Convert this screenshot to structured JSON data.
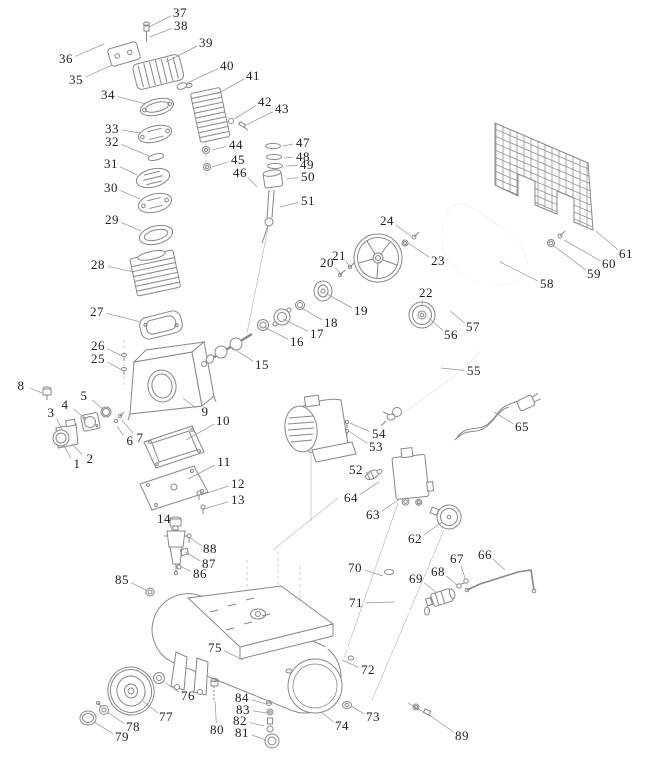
{
  "diagram": {
    "kind": "exploded-parts-diagram",
    "subject": "air compressor pump, motor, belt drive, tank and wheel assembly",
    "background_color": "#ffffff",
    "part_line_color": "#878787",
    "leader_line_color": "#9a9a9a",
    "label_color": "#1e1e1e",
    "label_count": 89,
    "labels": [
      {
        "n": "1",
        "x": 77,
        "y": 464,
        "tx": 64,
        "ty": 446
      },
      {
        "n": "2",
        "x": 90,
        "y": 459,
        "tx": 72,
        "ty": 444
      },
      {
        "n": "3",
        "x": 51,
        "y": 413,
        "tx": 62,
        "ty": 429
      },
      {
        "n": "4",
        "x": 65,
        "y": 405,
        "tx": 86,
        "ty": 419
      },
      {
        "n": "5",
        "x": 84,
        "y": 396,
        "tx": 104,
        "ty": 410
      },
      {
        "n": "6",
        "x": 130,
        "y": 441,
        "tx": 117,
        "ty": 426
      },
      {
        "n": "7",
        "x": 140,
        "y": 438,
        "tx": 122,
        "ty": 420
      },
      {
        "n": "8",
        "x": 21,
        "y": 386,
        "tx": 42,
        "ty": 393
      },
      {
        "n": "9",
        "x": 205,
        "y": 412,
        "tx": 183,
        "ty": 398
      },
      {
        "n": "10",
        "x": 223,
        "y": 421,
        "tx": 186,
        "ty": 440
      },
      {
        "n": "11",
        "x": 224,
        "y": 462,
        "tx": 188,
        "ty": 479
      },
      {
        "n": "12",
        "x": 238,
        "y": 484,
        "tx": 201,
        "ty": 495
      },
      {
        "n": "13",
        "x": 238,
        "y": 500,
        "tx": 204,
        "ty": 509
      },
      {
        "n": "14",
        "x": 164,
        "y": 519,
        "tx": 172,
        "ty": 530
      },
      {
        "n": "15",
        "x": 262,
        "y": 365,
        "tx": 231,
        "ty": 347
      },
      {
        "n": "16",
        "x": 297,
        "y": 342,
        "tx": 264,
        "ty": 327
      },
      {
        "n": "17",
        "x": 317,
        "y": 334,
        "tx": 283,
        "ty": 319
      },
      {
        "n": "18",
        "x": 331,
        "y": 323,
        "tx": 300,
        "ty": 307
      },
      {
        "n": "19",
        "x": 361,
        "y": 311,
        "tx": 327,
        "ty": 294
      },
      {
        "n": "20",
        "x": 327,
        "y": 263,
        "tx": 340,
        "ty": 273
      },
      {
        "n": "21",
        "x": 339,
        "y": 256,
        "tx": 350,
        "ty": 267
      },
      {
        "n": "22",
        "x": 426,
        "y": 293,
        "tx": 422,
        "ty": 305
      },
      {
        "n": "23",
        "x": 438,
        "y": 261,
        "tx": 408,
        "ty": 243
      },
      {
        "n": "24",
        "x": 387,
        "y": 221,
        "tx": 411,
        "ty": 236
      },
      {
        "n": "25",
        "x": 98,
        "y": 359,
        "tx": 122,
        "ty": 370
      },
      {
        "n": "26",
        "x": 98,
        "y": 346,
        "tx": 122,
        "ty": 356
      },
      {
        "n": "27",
        "x": 97,
        "y": 312,
        "tx": 141,
        "ty": 322
      },
      {
        "n": "28",
        "x": 98,
        "y": 265,
        "tx": 134,
        "ty": 272
      },
      {
        "n": "29",
        "x": 112,
        "y": 220,
        "tx": 141,
        "ty": 231
      },
      {
        "n": "30",
        "x": 111,
        "y": 188,
        "tx": 140,
        "ty": 199
      },
      {
        "n": "31",
        "x": 111,
        "y": 164,
        "tx": 137,
        "ty": 175
      },
      {
        "n": "32",
        "x": 112,
        "y": 142,
        "tx": 149,
        "ty": 156
      },
      {
        "n": "33",
        "x": 112,
        "y": 129,
        "tx": 140,
        "ty": 133
      },
      {
        "n": "34",
        "x": 108,
        "y": 95,
        "tx": 146,
        "ty": 104
      },
      {
        "n": "35",
        "x": 76,
        "y": 80,
        "tx": 112,
        "ty": 65
      },
      {
        "n": "36",
        "x": 66,
        "y": 59,
        "tx": 104,
        "ty": 44
      },
      {
        "n": "37",
        "x": 180,
        "y": 13,
        "tx": 149,
        "ty": 27
      },
      {
        "n": "38",
        "x": 181,
        "y": 26,
        "tx": 150,
        "ty": 37
      },
      {
        "n": "39",
        "x": 206,
        "y": 43,
        "tx": 166,
        "ty": 62
      },
      {
        "n": "40",
        "x": 227,
        "y": 66,
        "tx": 187,
        "ty": 83
      },
      {
        "n": "41",
        "x": 253,
        "y": 76,
        "tx": 217,
        "ty": 94
      },
      {
        "n": "42",
        "x": 265,
        "y": 102,
        "tx": 234,
        "ty": 119
      },
      {
        "n": "43",
        "x": 282,
        "y": 109,
        "tx": 244,
        "ty": 126
      },
      {
        "n": "44",
        "x": 236,
        "y": 145,
        "tx": 212,
        "ty": 150
      },
      {
        "n": "45",
        "x": 238,
        "y": 160,
        "tx": 212,
        "ty": 167
      },
      {
        "n": "46",
        "x": 240,
        "y": 173,
        "tx": 257,
        "ty": 187
      },
      {
        "n": "47",
        "x": 303,
        "y": 143,
        "tx": 283,
        "ty": 146
      },
      {
        "n": "48",
        "x": 303,
        "y": 157,
        "tx": 284,
        "ty": 158
      },
      {
        "n": "49",
        "x": 307,
        "y": 165,
        "tx": 286,
        "ty": 166
      },
      {
        "n": "50",
        "x": 308,
        "y": 177,
        "tx": 287,
        "ty": 179
      },
      {
        "n": "51",
        "x": 308,
        "y": 201,
        "tx": 280,
        "ty": 207
      },
      {
        "n": "52",
        "x": 356,
        "y": 470,
        "tx": 370,
        "ty": 474
      },
      {
        "n": "53",
        "x": 376,
        "y": 447,
        "tx": 349,
        "ty": 431
      },
      {
        "n": "54",
        "x": 379,
        "y": 434,
        "tx": 350,
        "ty": 423
      },
      {
        "n": "55",
        "x": 474,
        "y": 371,
        "tx": 441,
        "ty": 368
      },
      {
        "n": "56",
        "x": 451,
        "y": 335,
        "tx": 429,
        "ty": 318
      },
      {
        "n": "57",
        "x": 473,
        "y": 327,
        "tx": 450,
        "ty": 311
      },
      {
        "n": "58",
        "x": 547,
        "y": 284,
        "tx": 500,
        "ty": 262
      },
      {
        "n": "59",
        "x": 594,
        "y": 274,
        "tx": 554,
        "ty": 246
      },
      {
        "n": "60",
        "x": 609,
        "y": 264,
        "tx": 564,
        "ty": 240
      },
      {
        "n": "61",
        "x": 626,
        "y": 254,
        "tx": 596,
        "ty": 231
      },
      {
        "n": "62",
        "x": 415,
        "y": 539,
        "tx": 442,
        "ty": 522
      },
      {
        "n": "63",
        "x": 373,
        "y": 515,
        "tx": 401,
        "ty": 498
      },
      {
        "n": "64",
        "x": 351,
        "y": 498,
        "tx": 379,
        "ty": 482
      },
      {
        "n": "65",
        "x": 522,
        "y": 427,
        "tx": 494,
        "ty": 412
      },
      {
        "n": "66",
        "x": 485,
        "y": 555,
        "tx": 505,
        "ty": 570
      },
      {
        "n": "67",
        "x": 457,
        "y": 559,
        "tx": 465,
        "ty": 578
      },
      {
        "n": "68",
        "x": 438,
        "y": 572,
        "tx": 457,
        "ty": 585
      },
      {
        "n": "69",
        "x": 416,
        "y": 579,
        "tx": 437,
        "ty": 593
      },
      {
        "n": "70",
        "x": 355,
        "y": 568,
        "tx": 383,
        "ty": 576
      },
      {
        "n": "71",
        "x": 356,
        "y": 603,
        "tx": 395,
        "ty": 602
      },
      {
        "n": "72",
        "x": 368,
        "y": 670,
        "tx": 342,
        "ty": 660
      },
      {
        "n": "73",
        "x": 373,
        "y": 717,
        "tx": 351,
        "ty": 706
      },
      {
        "n": "74",
        "x": 342,
        "y": 726,
        "tx": 321,
        "ty": 712
      },
      {
        "n": "75",
        "x": 215,
        "y": 648,
        "tx": 243,
        "ty": 660
      },
      {
        "n": "76",
        "x": 188,
        "y": 696,
        "tx": 163,
        "ty": 681
      },
      {
        "n": "77",
        "x": 166,
        "y": 717,
        "tx": 143,
        "ty": 701
      },
      {
        "n": "78",
        "x": 133,
        "y": 727,
        "tx": 107,
        "ty": 712
      },
      {
        "n": "79",
        "x": 122,
        "y": 737,
        "tx": 94,
        "ty": 722
      },
      {
        "n": "80",
        "x": 217,
        "y": 730,
        "tx": 215,
        "ty": 701
      },
      {
        "n": "81",
        "x": 242,
        "y": 733,
        "tx": 266,
        "ty": 740
      },
      {
        "n": "82",
        "x": 240,
        "y": 721,
        "tx": 264,
        "ty": 726
      },
      {
        "n": "83",
        "x": 243,
        "y": 710,
        "tx": 267,
        "ty": 713
      },
      {
        "n": "84",
        "x": 242,
        "y": 698,
        "tx": 266,
        "ty": 704
      },
      {
        "n": "85",
        "x": 122,
        "y": 580,
        "tx": 146,
        "ty": 590
      },
      {
        "n": "86",
        "x": 200,
        "y": 574,
        "tx": 180,
        "ty": 566
      },
      {
        "n": "87",
        "x": 209,
        "y": 564,
        "tx": 185,
        "ty": 552
      },
      {
        "n": "88",
        "x": 210,
        "y": 549,
        "tx": 189,
        "ty": 537
      },
      {
        "n": "89",
        "x": 462,
        "y": 736,
        "tx": 428,
        "ty": 714
      }
    ]
  }
}
